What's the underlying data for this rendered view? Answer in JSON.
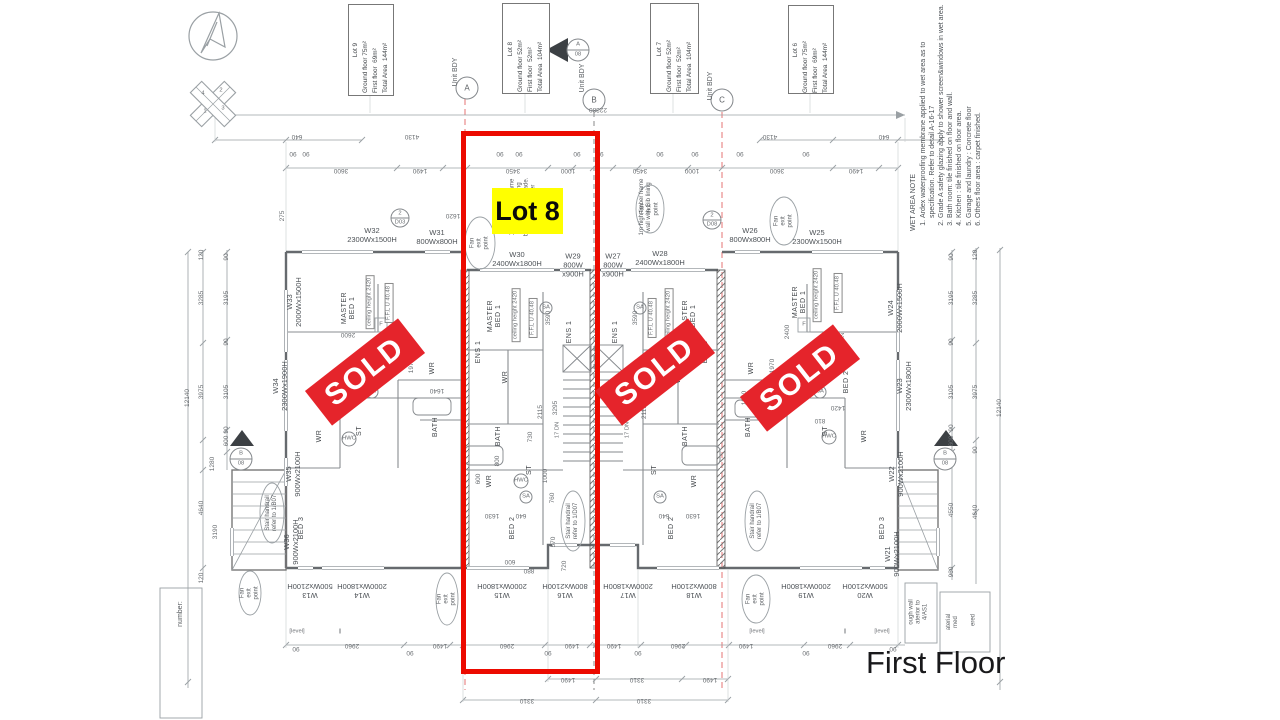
{
  "page": {
    "floor_label": "First Floor"
  },
  "colors": {
    "highlight_box_red": "#ec0a00",
    "sold_red": "#e5242b",
    "label_yellow": "#ffff00",
    "boundary_dash_red": "#e57373"
  },
  "compass": {
    "n1": "1",
    "n2": "2",
    "n3": "3",
    "n4": "4"
  },
  "lots": [
    {
      "name": "Lot 9",
      "ground": "Ground floor 75m²",
      "first": "First floor  69m²",
      "total": "Total Area  144m²"
    },
    {
      "name": "Lot 8",
      "ground": "Ground floor 52m²",
      "first": "First floor  52m²",
      "total": "Total Area  104m²"
    },
    {
      "name": "Lot 7",
      "ground": "Ground floor 52m²",
      "first": "First floor  52m²",
      "total": "Total Area  104m²"
    },
    {
      "name": "Lot 6",
      "ground": "Ground floor 75m²",
      "first": "First floor  69m²",
      "total": "Total Area  144m²"
    }
  ],
  "grid": {
    "unit_bdy": "Unit BDY",
    "a": "A",
    "b": "B",
    "c": "C",
    "sec_num": "08"
  },
  "highlight": {
    "label": "Lot 8"
  },
  "sold": "SOLD",
  "wet_note": {
    "title": "WET AREA NOTE",
    "items": [
      "Ardex waterproofing membrane applied to wet area as to specification. Refer to detail A-16-17",
      "Grade A safety glazing apply to shower screen&windows in wet area.",
      "Bath room: tile finished  on floor and wall.",
      "Kitchen : tile finished  on floor area.",
      "Garage and laundry  : Concrete floor",
      "Others floor area :  carpet finished."
    ]
  },
  "labels": {
    "master_bed": "MASTER\nBED 1",
    "ceiling": "ceiling height 2420",
    "ffl": "F.F.L U 40.48",
    "wr": "WR",
    "bath": "BATH",
    "bed2": "BED 2",
    "bed3": "BED 3",
    "st": "ST",
    "ens1": "ENS 1",
    "hwc": "HWC",
    "f": "F",
    "dn17": "17 DN",
    "sa": "SA",
    "fan": "Fan\nexit\npoint",
    "stair_b": "Stair handrail\nrefer to 1/B07",
    "stair_d": "Stair handrail\nrefer to 1/D07",
    "timber_full": "1m high timber frame\nwall with Gib lining\nboth sides balustrade.\nrefer to Engineer\ndrawing S&01",
    "timber_short": "1m high timber frame\nwall with Gib lining",
    "level": "[level]",
    "bars": "||",
    "number": "number:",
    "spec1": "ough wall\naterior to\n4/AS1",
    "spec2": "aterial\nmed",
    "spec3": "ered"
  },
  "tags": {
    "n2": "2",
    "d03": "D03",
    "d08": "D08"
  },
  "windows": {
    "w13": "W13\n500Wx2100H",
    "w14": "W14\n2000Wx1800H",
    "w15": "W15\n2000Wx1800H",
    "w16": "W16\n800Wx2100H",
    "w17": "W17\n2000Wx1800H",
    "w18": "W18\n800Wx2100H",
    "w19": "W19\n2000Wx1800H",
    "w20": "W20\n500Wx2100H",
    "w21": "W21\n900Wx2100H",
    "w22": "W22\n900Wx2100H",
    "w23": "W23\n2300Wx1800H",
    "w24": "W24\n2000Wx1500H",
    "w25": "W25\n2300Wx1500H",
    "w26": "W26\n800Wx800H",
    "w27": "W27\n800W\nx900H",
    "w28": "W28\n2400Wx1800H",
    "w29": "W29\n800W\nx900H",
    "w30": "W30\n2400Wx1800H",
    "w31": "W31\n800Wx800H",
    "w32": "W32\n2300Wx1500H",
    "w33": "W33\n2000Wx1500H",
    "w34": "W34\n2300Wx1900H",
    "w35": "W35\n900Wx2100H",
    "w36": "W36\n900Wx2100H"
  },
  "dims": {
    "v22380": "22380",
    "v640": "640",
    "v4130": "4130",
    "v3600": "3600",
    "v1490": "1490",
    "v3450": "3450",
    "v1000": "1000",
    "v90": "90",
    "v120": "120",
    "v2960": "2960",
    "v3310": "3310",
    "v3285": "3285",
    "v3195": "3195",
    "v3975": "3975",
    "v3105": "3105",
    "v12140": "12140",
    "v4640": "4640",
    "v4550": "4550",
    "v3190": "3190",
    "v1280": "1280",
    "v600": "600",
    "v960": "960",
    "v275": "275",
    "v2600": "2600",
    "v1640": "1640",
    "v1970": "1970",
    "v3590": "3590",
    "v3295": "3295",
    "v2115": "2115",
    "v730": "730",
    "v1630": "1630",
    "v760": "760",
    "v800": "800",
    "v880": "880",
    "v570": "570",
    "v720": "720",
    "v2400": "2400",
    "v1620": "1620",
    "v1840": "1840",
    "v1420": "1420",
    "v1800": "1800",
    "v810": "810"
  }
}
